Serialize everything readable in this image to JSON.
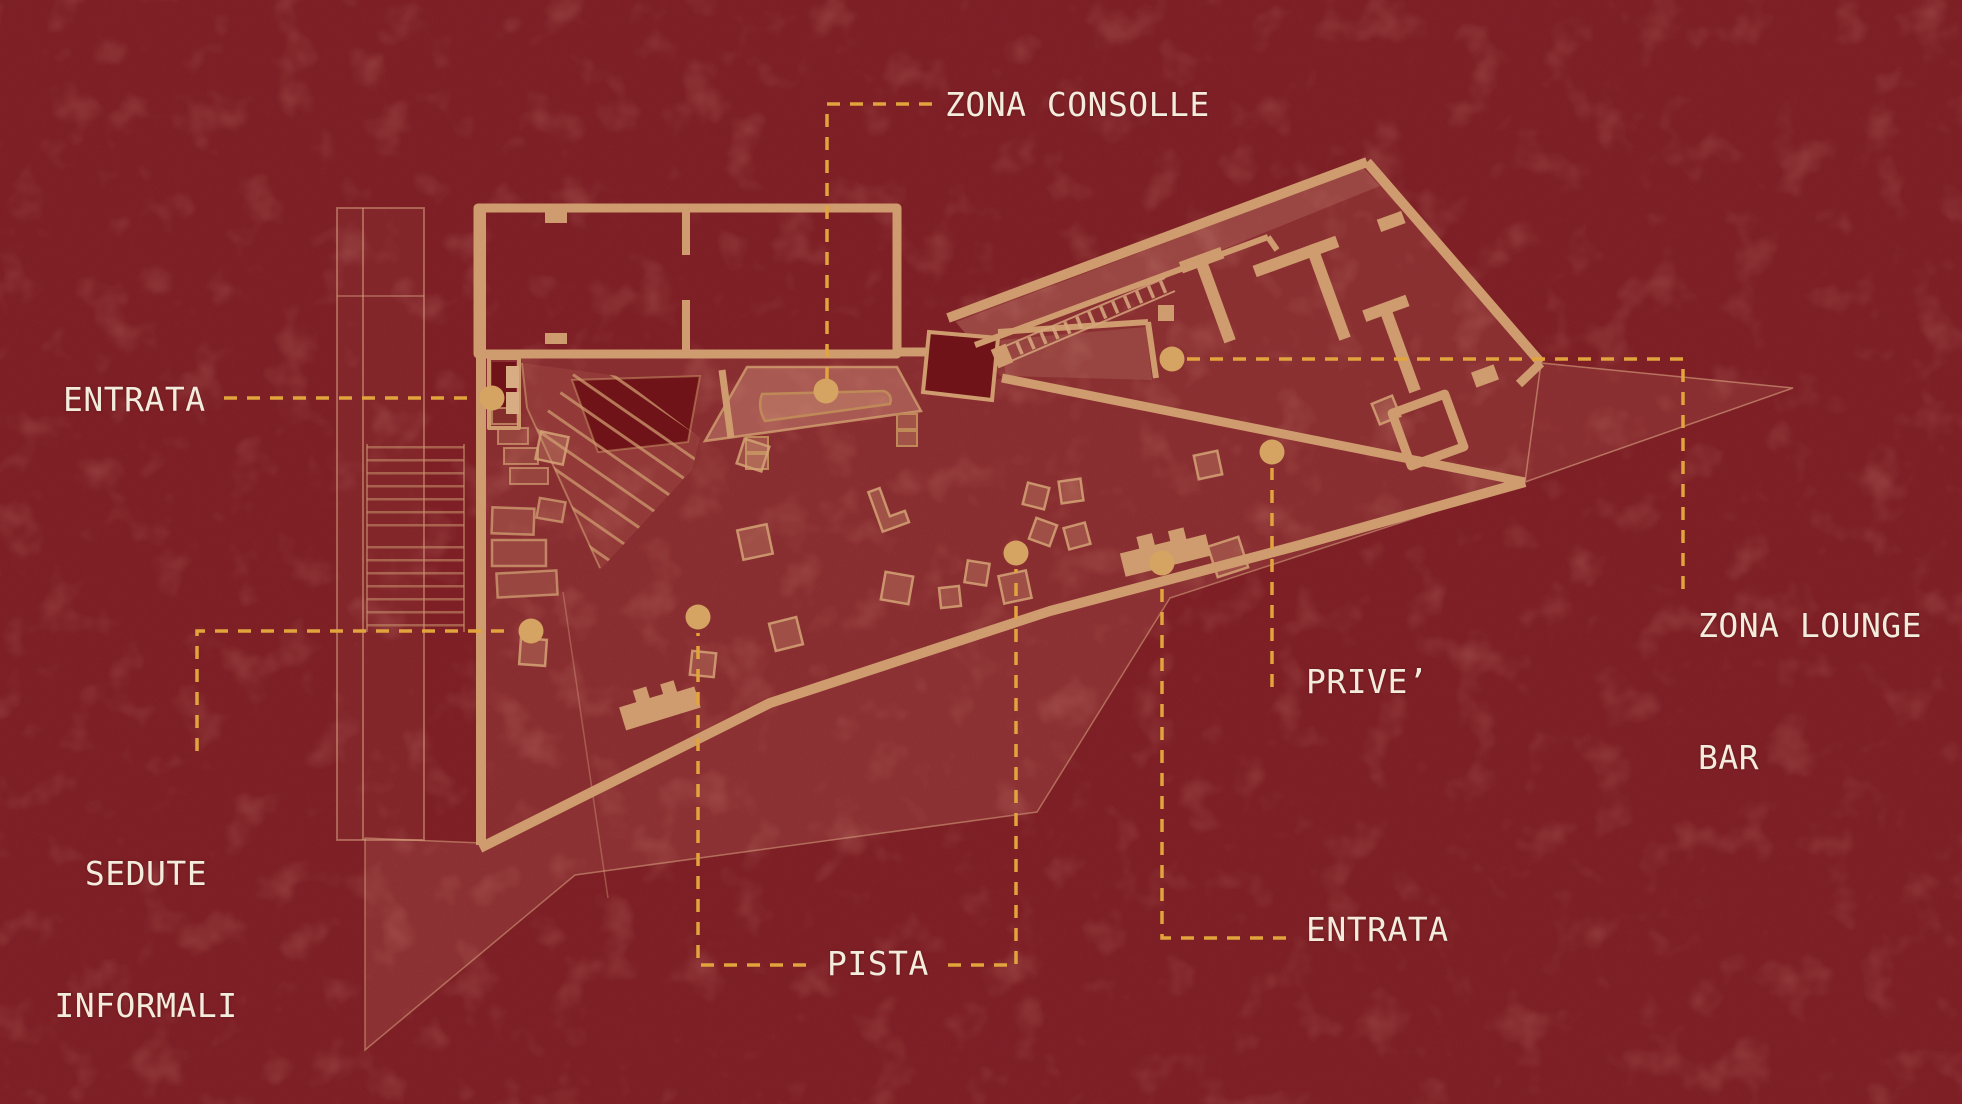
{
  "figure": {
    "type": "floor-plan-diagram",
    "labels": {
      "zona_consolle": "ZONA CONSOLLE",
      "entrata_left": "ENTRATA",
      "sedute_line1": "SEDUTE",
      "sedute_line2": "INFORMALI",
      "pista": "PISTA",
      "entrata_bottom": "ENTRATA",
      "prive": "PRIVE’",
      "lounge_line1": "ZONA LOUNGE",
      "lounge_line2": "BAR"
    },
    "zones": [
      "entrata-left",
      "zona-consolle",
      "sedute-informali",
      "pista-west",
      "pista-east",
      "entrata-south",
      "prive",
      "zona-lounge-bar"
    ],
    "colors": {
      "background": "#7d1f25",
      "plan_walls": "#cf9c6f",
      "dark_rooms": "#6f1318",
      "terrace_wash": "#e29c86",
      "leader_dash": "#e2a43c",
      "marker_dot": "#d5a362",
      "label_text": "#f3ecdd"
    }
  }
}
